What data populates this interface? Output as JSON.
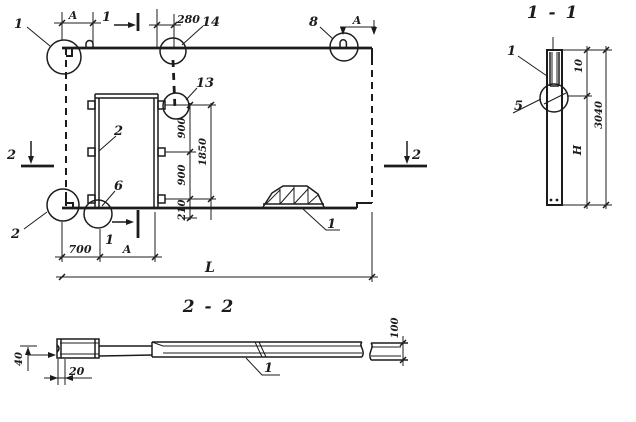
{
  "paper_color": "#ffffff",
  "ink_color": "#1c1c1c",
  "plan": {
    "section_marks": {
      "cut1_top": "1",
      "cut1_bottom": "1",
      "cut2_left": "2",
      "cut2_right": "2"
    },
    "callouts": {
      "corner_top_left": "1",
      "embed_14": "14",
      "loop_8": "8",
      "embed_13": "13",
      "opening_side_2": "2",
      "embed_6": "6",
      "corner_bottom_left_2": "2",
      "strongback_1": "1"
    },
    "dims": {
      "a_top_left": "A",
      "d280": "280",
      "a_top_right": "A",
      "d900_upper": "900",
      "d900_lower": "900",
      "d1850": "1850",
      "d210": "210",
      "d700": "700",
      "a_bottom": "A",
      "length": "L"
    }
  },
  "section_1_1": {
    "title": "1 - 1",
    "callouts": {
      "panel_1": "1",
      "joint_5": "5"
    },
    "dims": {
      "top": "10",
      "height": "H",
      "overall": "3040"
    }
  },
  "section_2_2": {
    "title": "2 - 2",
    "callouts": {
      "panel_1": "1"
    },
    "dims": {
      "left": "40",
      "offset": "20",
      "thickness": "100"
    }
  }
}
